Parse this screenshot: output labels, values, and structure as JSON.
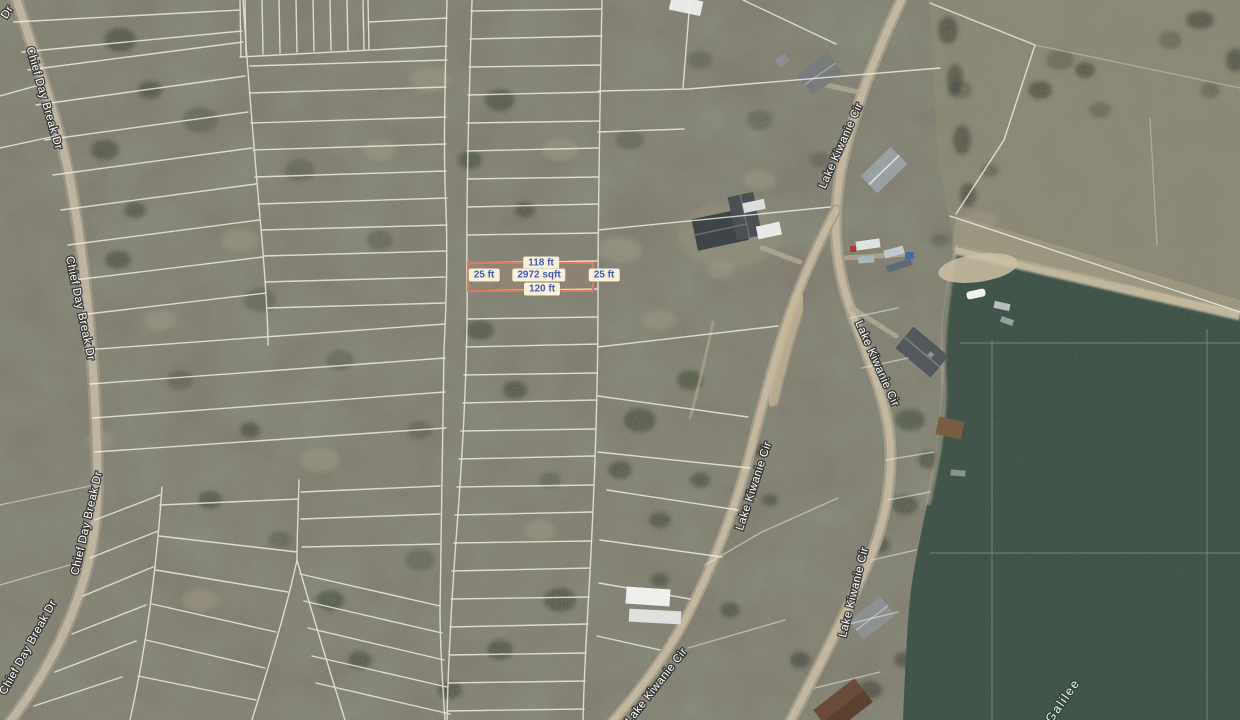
{
  "map": {
    "streets": {
      "chief_day_break": "Chief Day Break Dr",
      "chief_day_break_abbrev": "Dr",
      "lake_kiwanie": "Lake Kiwanie Cir"
    },
    "water": {
      "label": "Galilee"
    },
    "parcel_measurements": {
      "width_top": "118 ft",
      "side_left": "25 ft",
      "area": "2972 sqft",
      "side_right": "25 ft",
      "width_bottom": "120 ft"
    },
    "colors": {
      "parcel_outline": "#e0795c",
      "measurement_bg": "#f9f2d8",
      "measurement_text": "#4059c0",
      "water": "#41544a",
      "parcel_line": "#f3f1ea",
      "road_label_text": "#ffffff"
    }
  }
}
